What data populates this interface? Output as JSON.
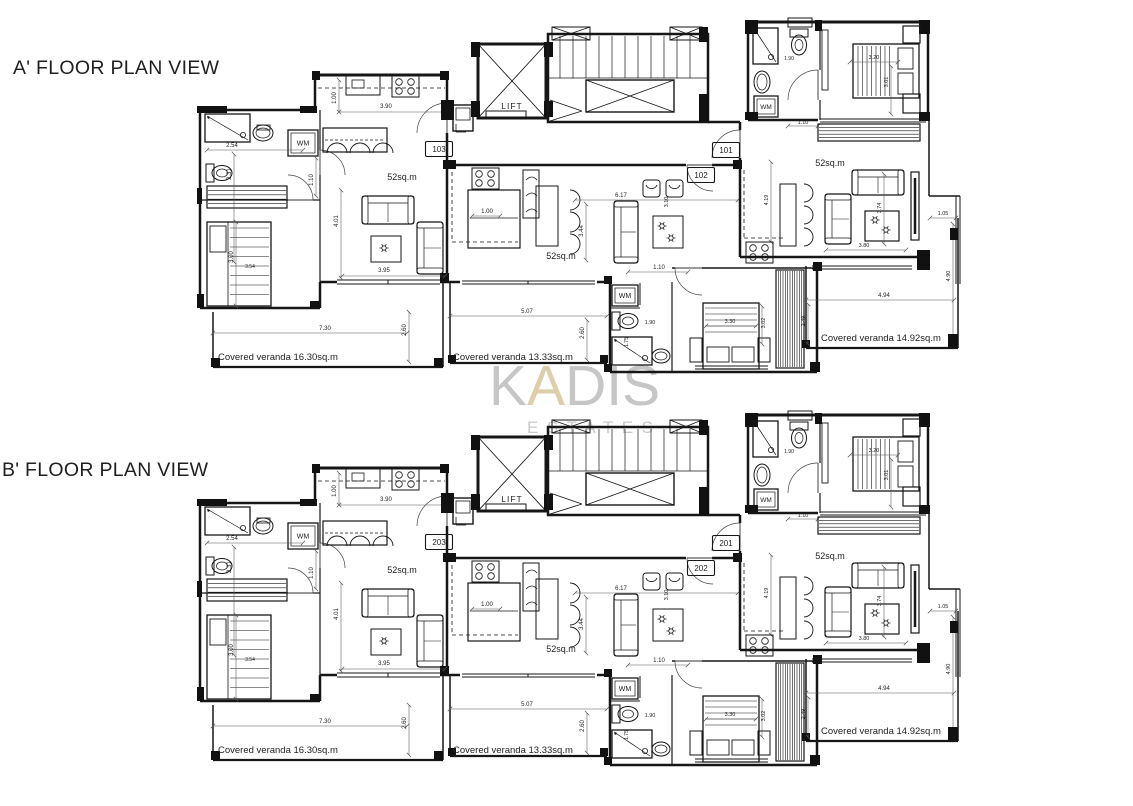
{
  "watermark": {
    "k": "K",
    "a": "A",
    "dis": "DIS",
    "sub": "ESTATES",
    "gray": "#c6c6c6",
    "accent": "#ddcfab"
  },
  "plans": [
    {
      "name": "A",
      "title": "A' FLOOR PLAN VIEW",
      "units": {
        "left": "103",
        "right": "101",
        "middle": "102"
      },
      "verandas": [
        "Covered veranda 16.30sq.m",
        "Covered veranda 13.33sq.m",
        "Covered veranda 14.92sq.m"
      ]
    },
    {
      "name": "B",
      "title": "B' FLOOR PLAN VIEW",
      "units": {
        "left": "203",
        "right": "201",
        "middle": "202"
      },
      "verandas": [
        "Covered veranda 16.30sq.m",
        "Covered veranda 13.33sq.m",
        "Covered veranda 14.92sq.m"
      ]
    }
  ],
  "labels": {
    "area": "52sq.m",
    "wm": "WM",
    "lift": "LIFT",
    "dims": {
      "2_54": "2.54",
      "2_31": "2.31",
      "3_00": "3.00",
      "3_54": "3.54",
      "1_00": "1.00",
      "3_90": "3.90",
      "1_10": "1.10",
      "4_01": "4.01",
      "3_95": "3.95",
      "7_30": "7.30",
      "2_60": "2.60",
      "3_44": "3.44",
      "6_17": "6.17",
      "5_07": "5.07",
      "1_90": "1.90",
      "1_75": "1.75",
      "3_30": "3.30",
      "3_02": "3.02",
      "2_49": "2.49",
      "3_20": "3.20",
      "3_01": "3.01",
      "4_19": "4.19",
      "3_74": "3.74",
      "3_80": "3.80",
      "4_94": "4.94",
      "4_90": "4.90",
      "1_05": "1.05",
      "3_10": "3.10"
    }
  }
}
